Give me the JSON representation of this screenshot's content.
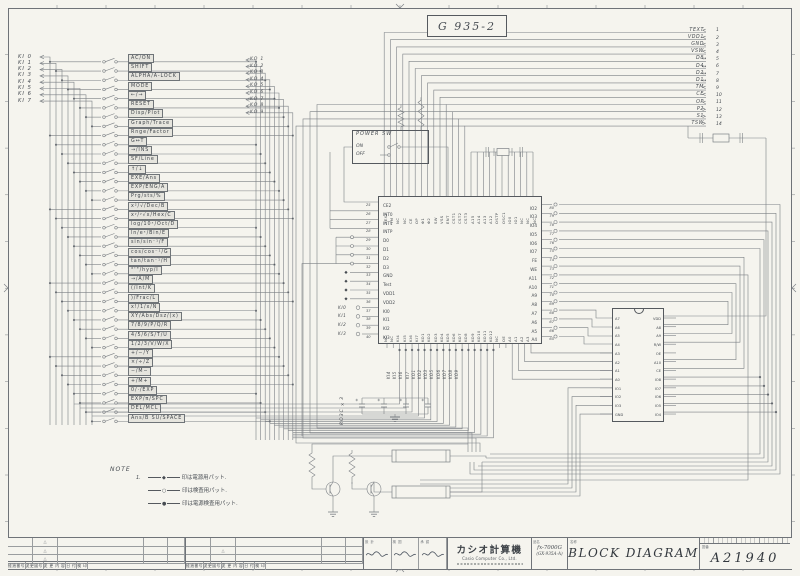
{
  "colors": {
    "ink": "#474c52",
    "wire": "#7c8085",
    "sheet": "#f5f4ee"
  },
  "sheet": {
    "doc_code": "G 935-2"
  },
  "right_connector": {
    "pins": [
      {
        "n": "1",
        "l": "TEXT",
        "d": "<"
      },
      {
        "n": "2",
        "l": "VDD1",
        "d": "<"
      },
      {
        "n": "3",
        "l": "GND",
        "d": "<"
      },
      {
        "n": "4",
        "l": "VSW",
        "d": "<"
      },
      {
        "n": "5",
        "l": "D8",
        "d": "↔"
      },
      {
        "n": "6",
        "l": "D4",
        "d": "↔"
      },
      {
        "n": "7",
        "l": "D2",
        "d": "↔"
      },
      {
        "n": "8",
        "l": "D1",
        "d": "↔"
      },
      {
        "n": "9",
        "l": "TM",
        "d": "<"
      },
      {
        "n": "10",
        "l": "CE",
        "d": "<"
      },
      {
        "n": "11",
        "l": "OP",
        "d": "<"
      },
      {
        "n": "12",
        "l": "P2",
        "d": ">"
      },
      {
        "n": "13",
        "l": "S1",
        "d": ">"
      },
      {
        "n": "14",
        "l": "TSW",
        "d": ">"
      }
    ]
  },
  "keyboard": {
    "ki": [
      "KI 0",
      "KI 1",
      "KI 2",
      "KI 3",
      "KI 4",
      "KI 5",
      "KI 6",
      "KI 7"
    ],
    "ko": [
      "KO 1",
      "KO 2",
      "KO 3",
      "KO 4",
      "KO 5",
      "KO 6",
      "KO 7",
      "KO 8",
      "KO 9"
    ],
    "keys": [
      "AC/ON",
      "SHIFT",
      "ALPHA/A-LOCK",
      "MODE",
      "←/→",
      "RESET",
      "Disp/Plot",
      "Graph/Trace",
      "Rnge/Factor",
      "G↔T",
      "→/INS",
      "SF/Line",
      "↑/↓",
      "EXE/Ans",
      "EXP/ENG/A",
      "Prg/sts/%",
      "x²/√/Dec/B",
      "xʸ/ʸ√x/Hex/C",
      "log/10ˣ/Oct/D",
      "ln/eˣ/Bin/E",
      "sin/sin⁻¹/F",
      "cos/cos⁻¹/G",
      "tan/tan⁻¹/H",
      "°'\"/hyp/I",
      "→/A/M",
      "(/Int/K",
      ")/Frac/L",
      "x!/1/x/N",
      "XY/Abs/Dsz/(x)",
      "7/8/9/P/Q/R",
      "4/5/6/S/T/U",
      "1/2/3/V/W/X",
      "+/−/Y",
      "×/÷/Z",
      "−/M−",
      "+/M+",
      "0/·/EXP",
      "EXP/π/SPC",
      "DEL/MCL",
      "Ans/B SU/SPACE"
    ]
  },
  "power_sw": {
    "title": "POWER SW",
    "on": "ON",
    "off": "OFF"
  },
  "main_ic": {
    "top_pins": [
      "TEXT",
      "TM",
      "NC",
      "NC",
      "CE",
      "OP",
      "Φ1",
      "Φ2",
      "SW",
      "VSS",
      "ENT",
      "CST1",
      "CST2",
      "CST3",
      "A15",
      "A14",
      "A13",
      "A12",
      "OSTP",
      "OSC1",
      "IO0",
      "IO1",
      "NC",
      "NC",
      "NC"
    ],
    "left_pins": [
      {
        "n": "25",
        "l": "CE2"
      },
      {
        "n": "26",
        "l": "INT0"
      },
      {
        "n": "27",
        "l": "INT1"
      },
      {
        "n": "28",
        "l": "INTP"
      },
      {
        "n": "29",
        "l": "D0"
      },
      {
        "n": "30",
        "l": "D1"
      },
      {
        "n": "31",
        "l": "D2"
      },
      {
        "n": "32",
        "l": "D3"
      },
      {
        "n": "33",
        "l": "GND"
      },
      {
        "n": "34",
        "l": "Test"
      },
      {
        "n": "35",
        "l": "VDD1"
      },
      {
        "n": "36",
        "l": "VDD2"
      },
      {
        "n": "37",
        "l": "KI0"
      },
      {
        "n": "38",
        "l": "KI1"
      },
      {
        "n": "39",
        "l": "KI2"
      },
      {
        "n": "40",
        "l": "KI3"
      }
    ],
    "right_pins": [
      {
        "n": "80",
        "l": "IO2"
      },
      {
        "n": "79",
        "l": "IO3"
      },
      {
        "n": "78",
        "l": "IO4"
      },
      {
        "n": "77",
        "l": "IO5"
      },
      {
        "n": "76",
        "l": "IO6"
      },
      {
        "n": "75",
        "l": "IO7"
      },
      {
        "n": "74",
        "l": "FE"
      },
      {
        "n": "73",
        "l": "WE"
      },
      {
        "n": "72",
        "l": "A11"
      },
      {
        "n": "71",
        "l": "A10"
      },
      {
        "n": "70",
        "l": "A9"
      },
      {
        "n": "69",
        "l": "A8"
      },
      {
        "n": "68",
        "l": "A7"
      },
      {
        "n": "67",
        "l": "A6"
      },
      {
        "n": "66",
        "l": "A5"
      },
      {
        "n": "65",
        "l": "A4"
      }
    ],
    "bottom_pins": [
      "NC",
      "NC",
      "KI4",
      "KI5",
      "KI6",
      "KI7",
      "KO1",
      "KO2",
      "KO3",
      "KO4",
      "KO5",
      "KO6",
      "KO7",
      "KO8",
      "KO9",
      "KO10",
      "KO11",
      "KO12",
      "NC",
      "OE",
      "A0",
      "A1",
      "A2",
      "A3"
    ],
    "bottom_external": [
      "KI4",
      "KI5",
      "KI6",
      "KI7",
      "KO1",
      "KO2",
      "KO3",
      "KO5",
      "KO6",
      "KO7",
      "KO8",
      "KO9"
    ],
    "left_external": [
      "KI0",
      "KI1",
      "KI2",
      "KI3"
    ]
  },
  "ram": {
    "left_pins": [
      "A7",
      "A6",
      "A5",
      "A4",
      "A3",
      "A2",
      "A1",
      "A0",
      "IO1",
      "IO2",
      "IO3",
      "GND"
    ],
    "right_pins": [
      "VDD",
      "A8",
      "A9",
      "R/W",
      "OE",
      "A10",
      "CE",
      "IO8",
      "IO7",
      "IO6",
      "IO5",
      "IO4"
    ]
  },
  "misc": {
    "r03c": "RO3C ×3"
  },
  "note": {
    "label": "NOTE",
    "item_no": "1.",
    "lines": [
      {
        "sym": "◆",
        "text": "印は電源用パット."
      },
      {
        "sym": "○",
        "text": "印は検査用パット."
      },
      {
        "sym": "●",
        "text": "印は電源検査用パット."
      }
    ]
  },
  "title_block": {
    "rev_headers": [
      "経過番号",
      "変更図号",
      "変 更 内 容",
      "日 付",
      "検 印"
    ],
    "rev_mark": "△",
    "approval_headers": [
      "設 計",
      "検 図",
      "承 認"
    ],
    "company": "カシオ計算機",
    "company_en": "Casio Computer Co., Ltd.",
    "part_label": "品名",
    "model": "fx-7000G",
    "model_sub": "(GX-935A-A)",
    "name_label": "名称",
    "title": "BLOCK DIAGRAM",
    "number_label": "図番",
    "drawing_number": "A21940"
  }
}
